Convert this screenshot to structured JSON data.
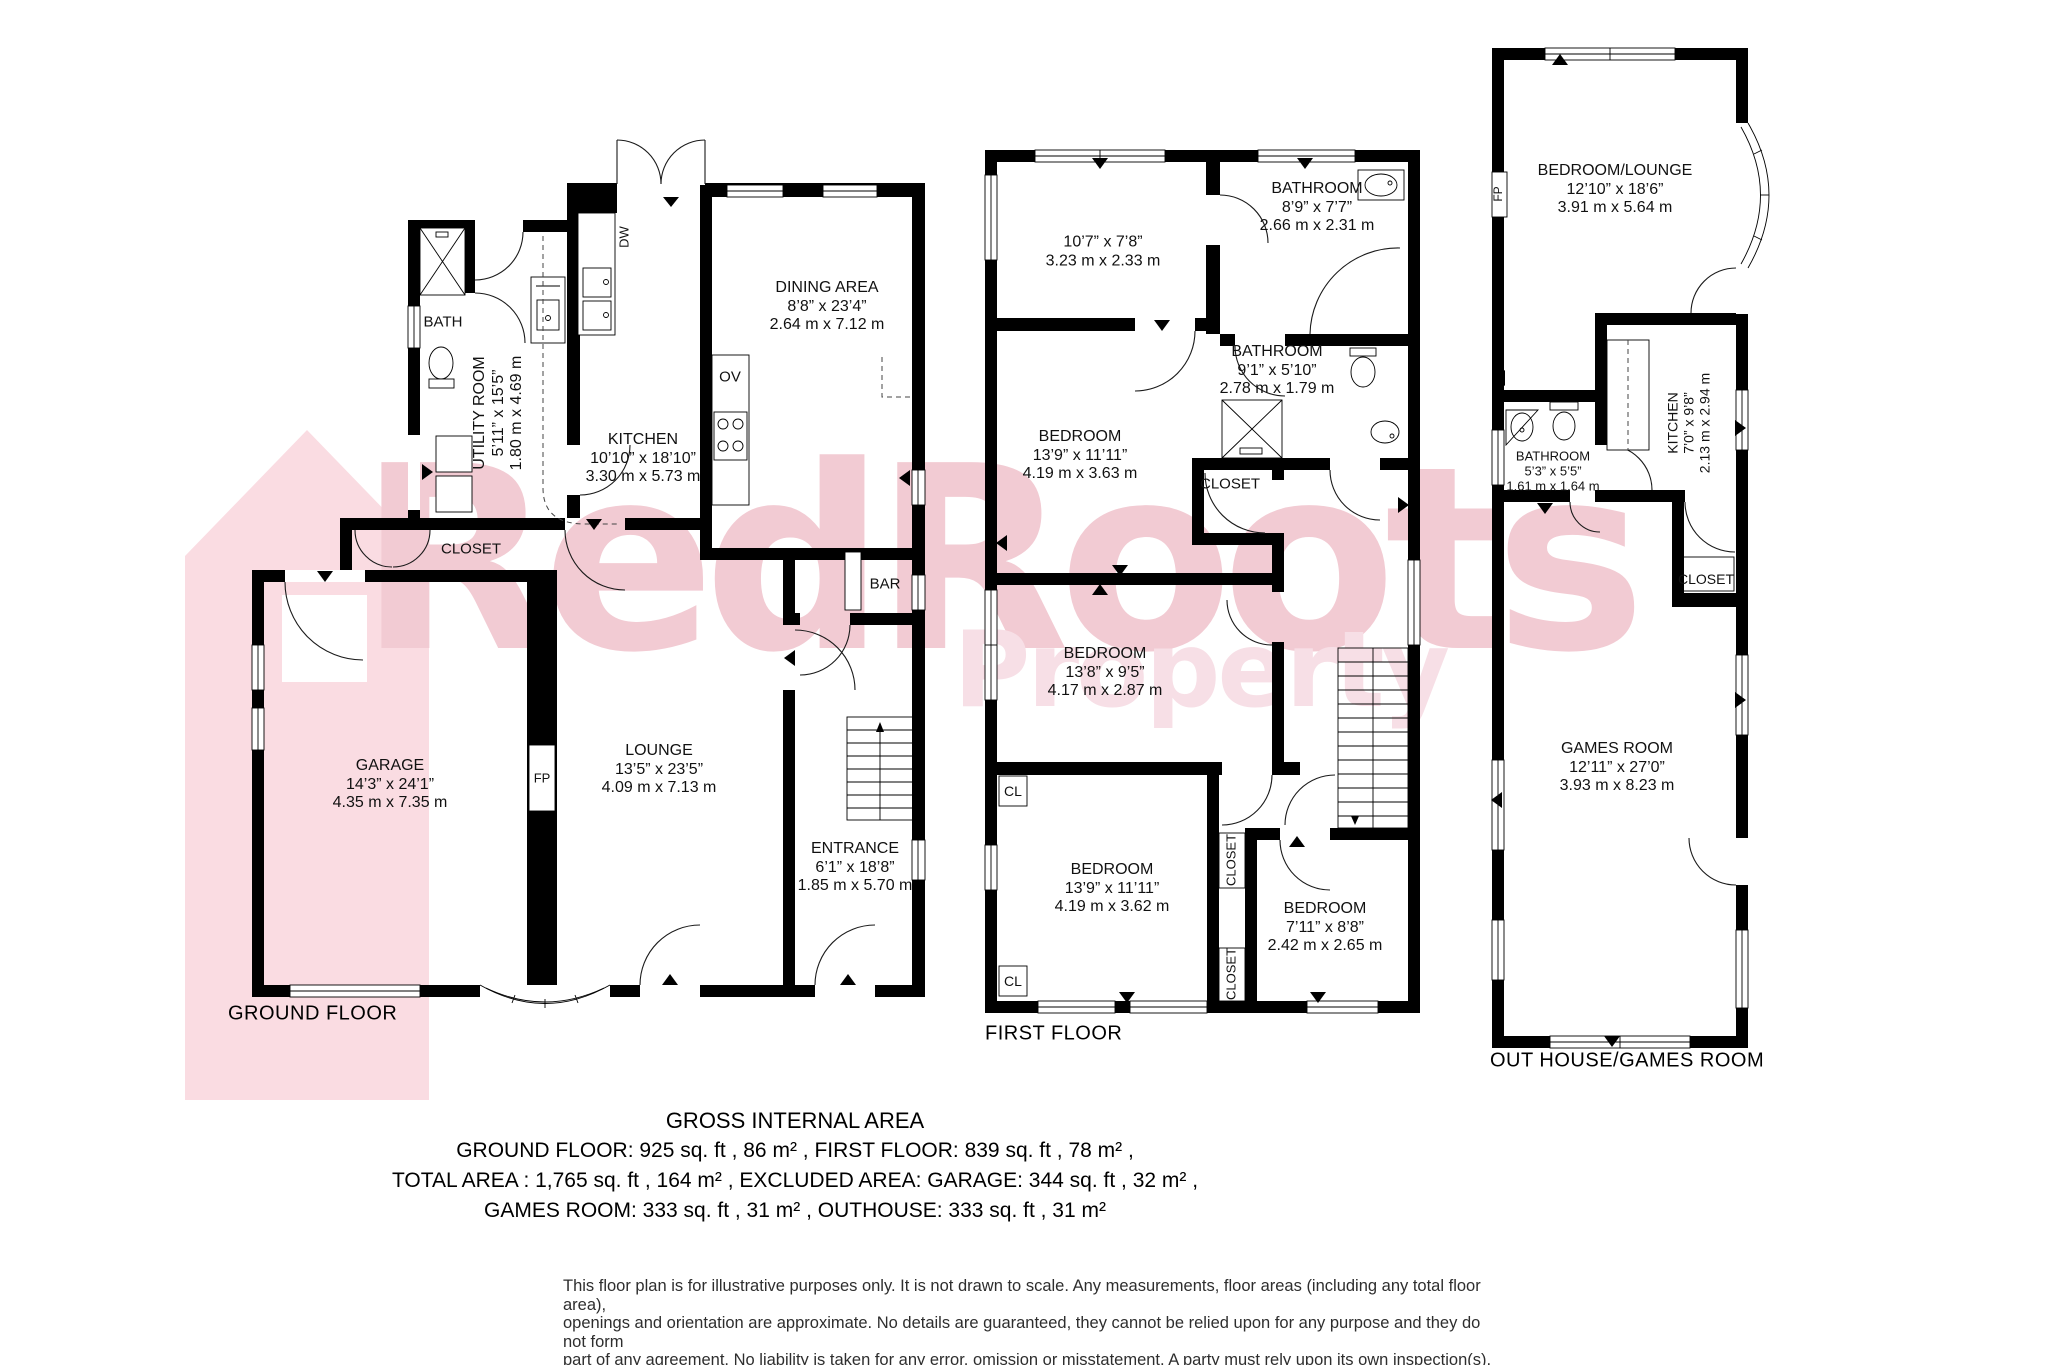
{
  "colors": {
    "wall": "#000000",
    "logo_pink": "#fadce2",
    "wm_pink": "#f2cbd3",
    "wm_light": "#f7dfe6",
    "ink": "#111111"
  },
  "watermark": {
    "brand": "RedRoots",
    "brand_sub": "Property"
  },
  "ground_floor": {
    "floor_label": "GROUND FLOOR",
    "rooms": {
      "bath": {
        "name": "BATH"
      },
      "utility": {
        "name": "UTILITY ROOM",
        "imperial": "5’11” x 15’5”",
        "metric": "1.80 m x 4.69 m"
      },
      "kitchen": {
        "name": "KITCHEN",
        "imperial": "10’10” x 18’10”",
        "metric": "3.30 m x 5.73 m"
      },
      "dining": {
        "name": "DINING AREA",
        "imperial": "8’8” x 23’4”",
        "metric": "2.64 m x 7.12 m"
      },
      "closet": {
        "name": "CLOSET"
      },
      "bar": {
        "name": "BAR"
      },
      "garage": {
        "name": "GARAGE",
        "imperial": "14’3” x 24’1”",
        "metric": "4.35 m x 7.35 m"
      },
      "lounge": {
        "name": "LOUNGE",
        "imperial": "13’5” x 23’5”",
        "metric": "4.09 m x 7.13 m"
      },
      "entrance": {
        "name": "ENTRANCE",
        "imperial": "6’1” x 18’8”",
        "metric": "1.85 m x 5.70 m"
      },
      "fireplace": {
        "name": "FP"
      },
      "oven": {
        "name": "OV"
      },
      "dishwasher": {
        "name": "DW"
      }
    }
  },
  "first_floor": {
    "floor_label": "FIRST FLOOR",
    "rooms": {
      "room": {
        "imperial": "10’7” x 7’8”",
        "metric": "3.23 m x 2.33 m"
      },
      "bathroom1": {
        "name": "BATHROOM",
        "imperial": "8’9” x 7’7”",
        "metric": "2.66 m x 2.31 m"
      },
      "bathroom2": {
        "name": "BATHROOM",
        "imperial": "9’1” x 5’10”",
        "metric": "2.78 m x 1.79 m"
      },
      "bedroom1": {
        "name": "BEDROOM",
        "imperial": "13’9” x 11’11”",
        "metric": "4.19 m x 3.63 m"
      },
      "bedroom2": {
        "name": "BEDROOM",
        "imperial": "13’8” x 9’5”",
        "metric": "4.17 m x 2.87 m"
      },
      "bedroom3": {
        "name": "BEDROOM",
        "imperial": "13’9” x 11’11”",
        "metric": "4.19 m x 3.62 m"
      },
      "bedroom4": {
        "name": "BEDROOM",
        "imperial": "7’11” x 8’8”",
        "metric": "2.42 m x 2.65 m"
      },
      "closet_hall": {
        "name": "CLOSET"
      },
      "closet_top": {
        "name": "CLOSET"
      },
      "closet_bottom": {
        "name": "CLOSET"
      },
      "cl1": {
        "name": "CL"
      },
      "cl2": {
        "name": "CL"
      }
    }
  },
  "outhouse": {
    "floor_label": "OUT HOUSE/GAMES ROOM",
    "rooms": {
      "bedroom_lounge": {
        "name": "BEDROOM/LOUNGE",
        "imperial": "12’10” x 18’6”",
        "metric": "3.91 m x 5.64 m"
      },
      "kitchen": {
        "name": "KITCHEN",
        "imperial": "7’0” x 9’8”",
        "metric": "2.13 m x 2.94 m"
      },
      "bathroom": {
        "name": "BATHROOM",
        "imperial": "5’3” x 5’5”",
        "metric": "1.61 m x 1.64 m"
      },
      "closet": {
        "name": "CLOSET"
      },
      "games_room": {
        "name": "GAMES ROOM",
        "imperial": "12’11” x 27’0”",
        "metric": "3.93 m x 8.23 m"
      },
      "fireplace": {
        "name": "FP"
      }
    }
  },
  "area_summary": {
    "title": "GROSS INTERNAL AREA",
    "line1": "GROUND FLOOR: 925 sq. ft , 86 m² , FIRST FLOOR: 839 sq. ft , 78 m² ,",
    "line2": "TOTAL AREA : 1,765 sq. ft , 164 m² , EXCLUDED AREA: GARAGE: 344 sq. ft , 32 m² ,",
    "line3": "GAMES ROOM: 333 sq. ft , 31 m² , OUTHOUSE: 333 sq. ft , 31 m²"
  },
  "disclaimer": {
    "line1": "This floor plan is for illustrative purposes only. It is not drawn to scale. Any measurements, floor areas (including any total floor area),",
    "line2": "openings and orientation are approximate. No details are guaranteed, they cannot be relied upon for any purpose and they do not form",
    "line3": "part of any agreement. No liability is taken for any error, omission or misstatement. A party must rely upon its own inspection(s)."
  }
}
